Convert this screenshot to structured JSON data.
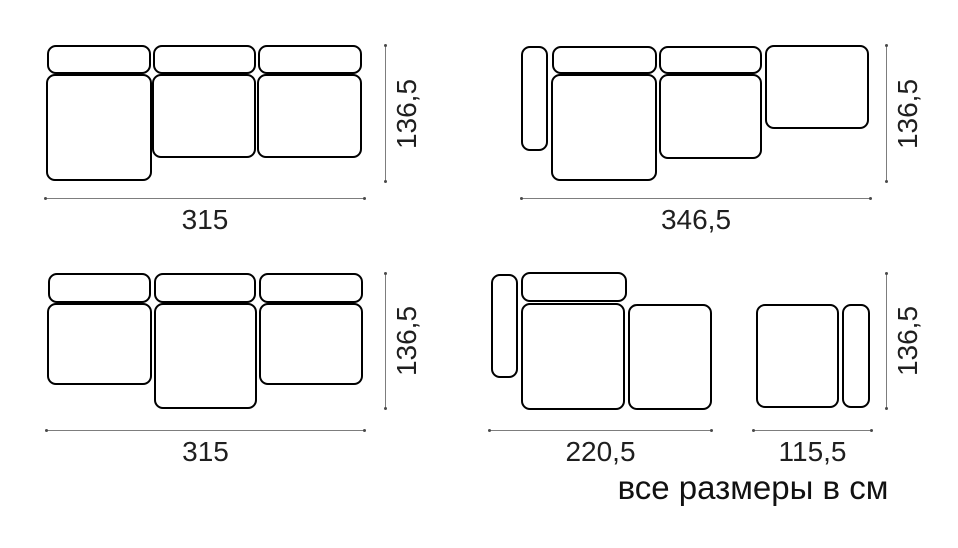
{
  "footer": {
    "note": "все размеры в см"
  },
  "colors": {
    "background": "#ffffff",
    "piece_outline": "#000000",
    "dimension_line": "#7d7d7d",
    "label_text": "#1f1f1f"
  },
  "diagrams": [
    {
      "id": "sofa-three-module-left-chaise",
      "width_label": "315",
      "height_label": "136,5",
      "pieces": [
        {
          "name": "backrest-left",
          "x": 47,
          "y": 45,
          "w": 104,
          "h": 29
        },
        {
          "name": "backrest-middle",
          "x": 153,
          "y": 45,
          "w": 103,
          "h": 29
        },
        {
          "name": "backrest-right",
          "x": 258,
          "y": 45,
          "w": 104,
          "h": 29
        },
        {
          "name": "chaise-seat-left",
          "x": 46,
          "y": 74,
          "w": 106,
          "h": 107
        },
        {
          "name": "seat-middle",
          "x": 152,
          "y": 74,
          "w": 104,
          "h": 84
        },
        {
          "name": "seat-right",
          "x": 257,
          "y": 74,
          "w": 105,
          "h": 84
        }
      ],
      "dims": [
        {
          "type": "h",
          "x1": 45,
          "x2": 365,
          "y": 198,
          "label": "315"
        },
        {
          "type": "v",
          "x": 385,
          "y1": 45,
          "y2": 182,
          "label": "136,5"
        }
      ]
    },
    {
      "id": "sofa-armrest-left-open-end-right",
      "width_label": "346,5",
      "height_label": "136,5",
      "pieces": [
        {
          "name": "armrest-left",
          "x": 521,
          "y": 46,
          "w": 27,
          "h": 105
        },
        {
          "name": "backrest-left",
          "x": 552,
          "y": 46,
          "w": 105,
          "h": 28
        },
        {
          "name": "backrest-right",
          "x": 659,
          "y": 46,
          "w": 103,
          "h": 28
        },
        {
          "name": "open-end-right",
          "x": 765,
          "y": 45,
          "w": 104,
          "h": 84
        },
        {
          "name": "chaise-seat-left",
          "x": 551,
          "y": 74,
          "w": 106,
          "h": 107
        },
        {
          "name": "seat-middle",
          "x": 659,
          "y": 74,
          "w": 103,
          "h": 85
        }
      ],
      "dims": [
        {
          "type": "h",
          "x1": 521,
          "x2": 871,
          "y": 198,
          "label": "346,5"
        },
        {
          "type": "v",
          "x": 886,
          "y1": 45,
          "y2": 182,
          "label": "136,5"
        }
      ]
    },
    {
      "id": "sofa-three-module-middle-chaise",
      "width_label": "315",
      "height_label": "136,5",
      "pieces": [
        {
          "name": "backrest-left",
          "x": 48,
          "y": 273,
          "w": 103,
          "h": 30
        },
        {
          "name": "backrest-middle",
          "x": 154,
          "y": 273,
          "w": 102,
          "h": 30
        },
        {
          "name": "backrest-right",
          "x": 259,
          "y": 273,
          "w": 104,
          "h": 30
        },
        {
          "name": "seat-left",
          "x": 47,
          "y": 303,
          "w": 105,
          "h": 82
        },
        {
          "name": "chaise-seat-middle",
          "x": 154,
          "y": 303,
          "w": 103,
          "h": 106
        },
        {
          "name": "seat-right",
          "x": 259,
          "y": 303,
          "w": 104,
          "h": 82
        }
      ],
      "dims": [
        {
          "type": "h",
          "x1": 46,
          "x2": 365,
          "y": 430,
          "label": "315"
        },
        {
          "type": "v",
          "x": 385,
          "y1": 273,
          "y2": 409,
          "label": "136,5"
        }
      ]
    },
    {
      "id": "sofa-module-with-ottoman-pair",
      "width_label_left": "220,5",
      "width_label_right": "115,5",
      "height_label": "136,5",
      "pieces": [
        {
          "name": "armrest-left",
          "x": 491,
          "y": 274,
          "w": 27,
          "h": 104
        },
        {
          "name": "backrest",
          "x": 521,
          "y": 272,
          "w": 106,
          "h": 30
        },
        {
          "name": "chaise-seat",
          "x": 521,
          "y": 303,
          "w": 104,
          "h": 107
        },
        {
          "name": "ottoman",
          "x": 628,
          "y": 304,
          "w": 84,
          "h": 106
        },
        {
          "name": "ottoman-square",
          "x": 756,
          "y": 304,
          "w": 83,
          "h": 104
        },
        {
          "name": "side-element",
          "x": 842,
          "y": 304,
          "w": 28,
          "h": 104
        }
      ],
      "dims": [
        {
          "type": "h",
          "x1": 489,
          "x2": 712,
          "y": 430,
          "label": "220,5"
        },
        {
          "type": "h",
          "x1": 753,
          "x2": 872,
          "y": 430,
          "label": "115,5"
        },
        {
          "type": "v",
          "x": 886,
          "y1": 273,
          "y2": 409,
          "label": "136,5"
        }
      ]
    }
  ]
}
